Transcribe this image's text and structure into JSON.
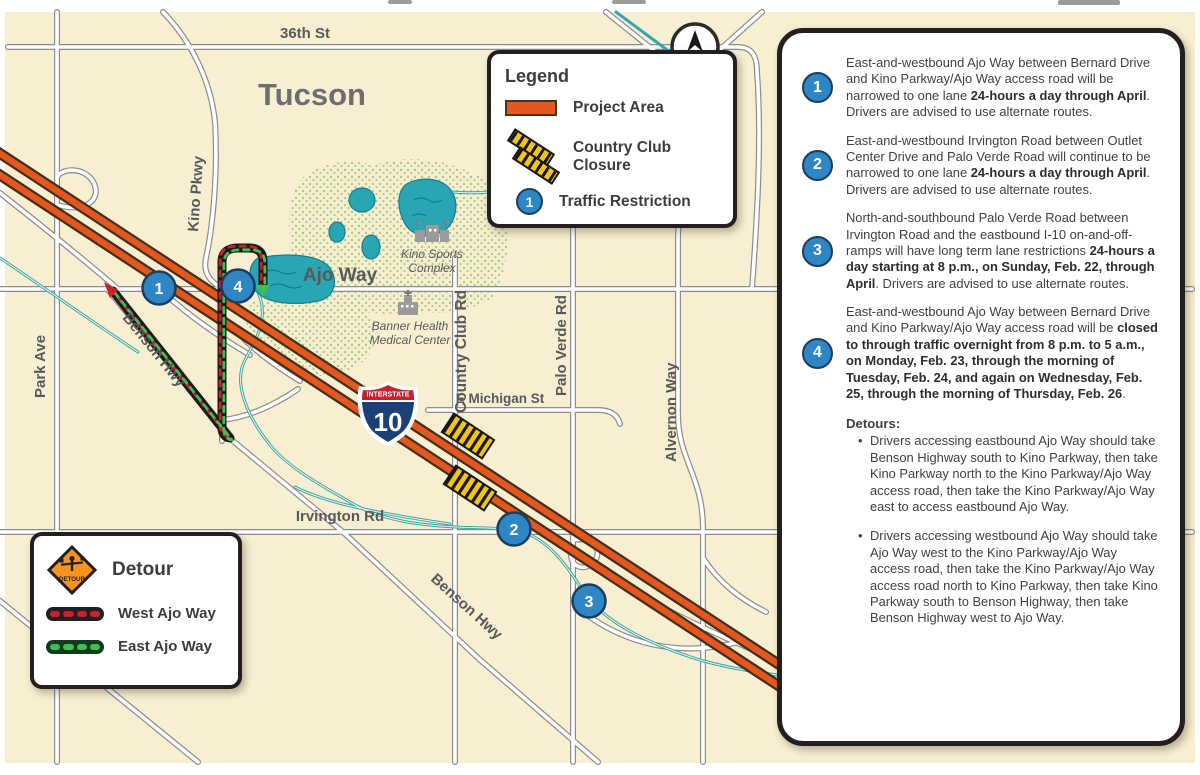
{
  "map": {
    "city": "Tucson",
    "labels": {
      "street_36th": "36th St",
      "kino_pkwy": "Kino Pkwy",
      "ajo_way": "Ajo Way",
      "park_ave": "Park Ave",
      "benson_hwy": "Benson Hwy",
      "country_club_rd": "Country Club Rd",
      "e_michigan_st": "E Michigan St",
      "palo_verde_rd": "Palo Verde Rd",
      "alvernon_way": "Alvernon Way",
      "irvington_rd": "Irvington Rd"
    },
    "pois": {
      "kino_sports_line1": "Kino Sports",
      "kino_sports_line2": "Complex",
      "banner_line1": "Banner Health",
      "banner_line2": "Medical Center"
    },
    "shield": {
      "top": "INTERSTATE",
      "number": "10"
    },
    "compass_n": "N",
    "markers": [
      {
        "label": "1"
      },
      {
        "label": "2"
      },
      {
        "label": "3"
      },
      {
        "label": "4"
      }
    ]
  },
  "legend": {
    "title": "Legend",
    "items": [
      {
        "label": "Project Area"
      },
      {
        "label": "Country Club Closure"
      },
      {
        "label": "Traffic Restriction",
        "badge": "1"
      }
    ]
  },
  "detour_legend": {
    "title": "Detour",
    "sign_text": "DETOUR",
    "items": [
      {
        "label": "West Ajo Way"
      },
      {
        "label": "East Ajo Way"
      }
    ]
  },
  "panel": {
    "items": [
      {
        "number": "1",
        "segments": [
          {
            "t": "East-and-westbound Ajo Way between Bernard Drive and Kino Parkway/Ajo Way access road will be narrowed to one lane "
          },
          {
            "t": "24-hours a day through April",
            "b": true
          },
          {
            "t": ". Drivers are advised to use alternate routes."
          }
        ]
      },
      {
        "number": "2",
        "segments": [
          {
            "t": "East-and-westbound Irvington Road between Outlet Center Drive and Palo Verde Road will continue to be narrowed to one lane "
          },
          {
            "t": "24-hours a day through April",
            "b": true
          },
          {
            "t": ". Drivers are advised to use alternate routes."
          }
        ]
      },
      {
        "number": "3",
        "segments": [
          {
            "t": "North-and-southbound Palo Verde Road between Irvington Road and the eastbound I-10 on-and-off-ramps will have long term lane restrictions "
          },
          {
            "t": "24-hours a day starting at 8 p.m., on Sunday, Feb. 22, through April",
            "b": true
          },
          {
            "t": ". Drivers are advised to use alternate routes."
          }
        ]
      },
      {
        "number": "4",
        "segments": [
          {
            "t": "East-and-westbound Ajo Way between Bernard Drive and Kino Parkway/Ajo Way access road will be "
          },
          {
            "t": "closed to through traffic overnight from 8 p.m. to 5 a.m., on Monday, Feb. 23, through the morning of Tuesday, Feb. 24, and again on Wednesday, Feb. 25, through the morning of Thursday, Feb. 26",
            "b": true
          },
          {
            "t": "."
          }
        ]
      }
    ],
    "detours_heading": "Detours:",
    "detour_bullets": [
      "Drivers accessing eastbound Ajo Way should take Benson Highway south to Kino Parkway, then take Kino Parkway north to the Kino Parkway/Ajo Way access road, then take the Kino Parkway/Ajo Way east to access eastbound Ajo Way.",
      "Drivers accessing westbound Ajo Way should take Ajo Way west to the Kino Parkway/Ajo Way access road, then take the Kino Parkway/Ajo Way access road north to Kino Parkway, then take Kino Parkway south to Benson Highway, then take Benson Highway west to Ajo Way."
    ]
  },
  "colors": {
    "map_bg": "#f8eed1",
    "freeway_orange": "#e4571f",
    "freeway_casing": "#43301a",
    "water_teal": "#2ea7b4",
    "marker_blue": "#2e86c4",
    "closure_yellow": "#f3c613",
    "detour_red": "#cc2027",
    "detour_green": "#3fbf52",
    "label_gray": "#58595b"
  }
}
